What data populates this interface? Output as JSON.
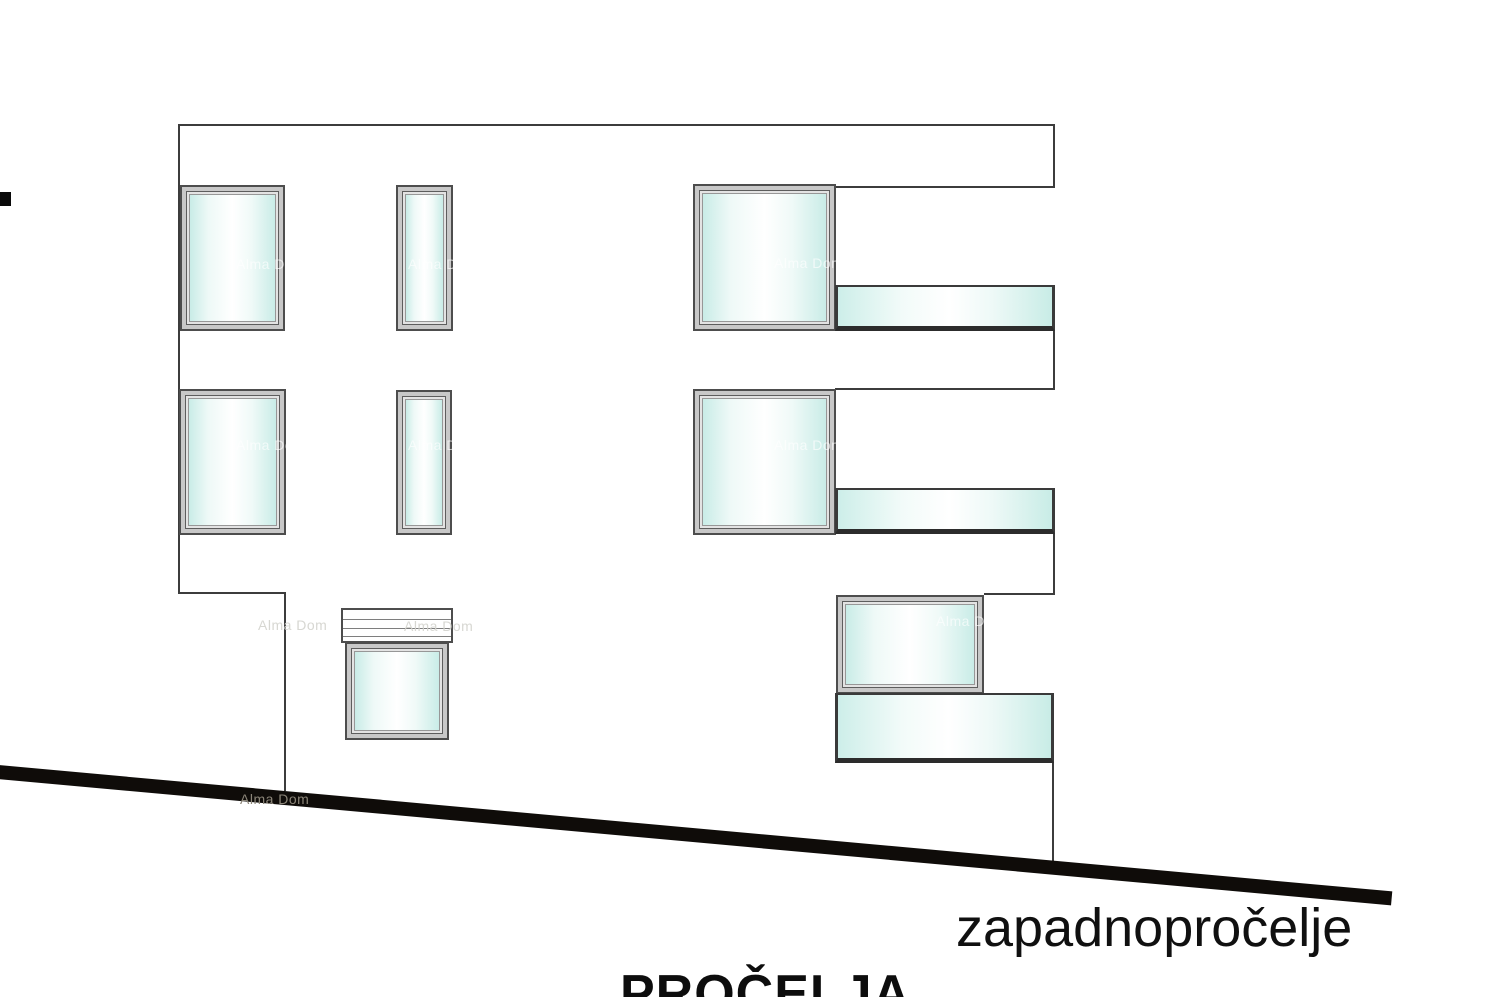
{
  "drawing": {
    "kind": "architectural elevation drawing",
    "facade_label": "zapadnopročelje",
    "sheet_title": "PROČELJA"
  },
  "watermark": {
    "text": "Alma Dom"
  },
  "colors": {
    "background": "#ffffff",
    "outline": "#3c3c3c",
    "window_frame": "#c8c8c8",
    "glass_tint": "#c9ece7",
    "glass_highlight": "#ffffff",
    "balustrade_edge": "#2c2c2c",
    "ground_line": "#0f0c09",
    "watermark_on_ground": "#8b8578",
    "watermark_on_glass": "rgba(255,255,255,0.65)",
    "label_text": "#101010"
  }
}
